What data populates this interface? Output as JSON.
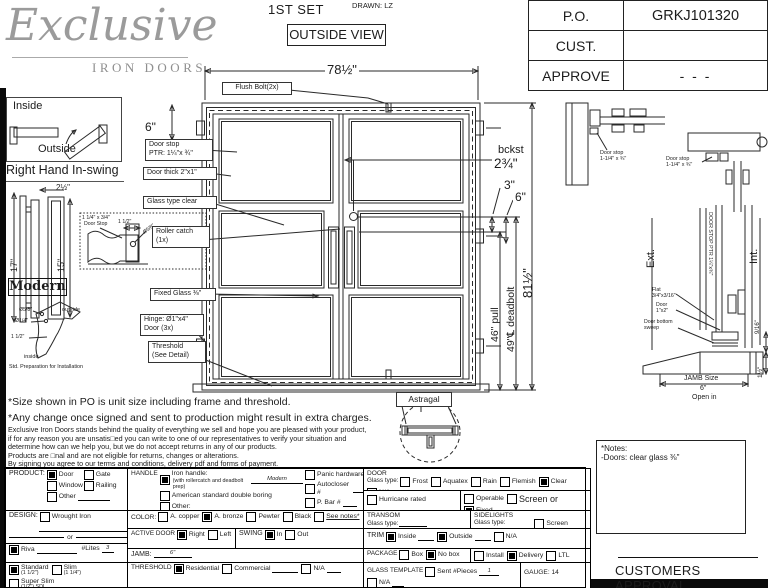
{
  "header": {
    "logo": "Exclusive",
    "logo_sub": "IRON DOORS",
    "set": "1ST SET",
    "drawn": "DRAWN: LZ",
    "view": "OUTSIDE VIEW"
  },
  "po": {
    "rows": [
      {
        "label": "P.O.",
        "value": "GRKJ101320"
      },
      {
        "label": "CUST.",
        "value": ""
      },
      {
        "label": "APPROVE",
        "value": "- - -"
      }
    ]
  },
  "legend": {
    "inside": "Inside",
    "outside": "Outside",
    "caption": "Right Hand In-swing"
  },
  "handle_detail": {
    "width": "2½\"",
    "h1": "17\"",
    "h2": "15\"",
    "style": "Modern"
  },
  "stop_detail": {
    "l1": "1 1/4\" x 3/4\"",
    "l2": "Door Stop",
    "dim": "1 1/2\"",
    "hole": "Ø5/8\""
  },
  "prep_detail": {
    "d1": "Ø5/8\"",
    "d2": "Ø1/4\"",
    "d3": "1 1/2\"",
    "outside": "outside",
    "inside": "inside",
    "caption": "Std. Preparation for Installation"
  },
  "drawing": {
    "width": "78½\"",
    "flush_bolt": "Flush Bolt(2x)",
    "top_rail": "6\"",
    "door_stop": "Door stop\nPTR: 1¼\"x ¾\"",
    "door_thick": "Door thick 2\"x1\"",
    "glass_type": "Glass type clear",
    "roller": "Roller catch\n(1x)",
    "fixed_glass": "Fixed Glass ⅜\"",
    "hinge": "Hinge: Ø1\"x4\"\nDoor (3x)",
    "threshold": "Threshold\n(See Detail)",
    "bckst": "bckst",
    "backset": "2¾\"",
    "d3": "3\"",
    "d6": "6\"",
    "height": "81½\"",
    "deadbolt": "49\"℄ deadbolt",
    "pull": "46\" pull",
    "astragal": "Astragal"
  },
  "jamb": {
    "stop_a": "Door stop\n1-1/4\" x ¾\"",
    "stop_b": "Door stop\n1-1/4\" x ¾\""
  },
  "sill": {
    "ext": "Ext.",
    "int": "Int.",
    "stop_ptr": "DOOR STOP PTR 1¼\"x¾\"",
    "flat": "Flat\n3/4\"x3/16\"",
    "door": "Door\n1\"x2\"",
    "sweep": "Door bottom\nsweep",
    "jamb_size": "JAMB Size",
    "jamb_dim": "6\"",
    "open": "Open in",
    "d916": "9/16\"",
    "d112": "1½\""
  },
  "disclaimer": {
    "l1": "*Size shown in PO is unit size including frame and threshold.",
    "l2": "*Any change once signed and sent to production might result in extra charges.",
    "l3": "Exclusive Iron Doors stands behind the quality of everything we sell and hope you are pleased with your product,",
    "l4": "if for any reason you are unsatis□ed you can write to one of our representatives to verify your situation and",
    "l5": "determine how can we help you, but we do not accept returns in any of our products.",
    "l6": "Products are □nal and are not eligible for returns, changes or alterations.",
    "l7": "By signing you agree to our terms and conditions, delivery pdf and forms of payment.",
    "l8": "*Doors measurements do not include the gaps between jambs"
  },
  "form": {
    "product": {
      "label": "PRODUCT:",
      "options": [
        {
          "label": "Door",
          "checked": true,
          "w": 34
        },
        {
          "label": "Gate",
          "w": 30
        },
        {
          "label": "Window",
          "w": 34
        },
        {
          "label": "Railing",
          "w": 30
        },
        {
          "label": "Other",
          "line": 32
        }
      ]
    },
    "design": {
      "label": "DESIGN:",
      "options": [
        {
          "label": "Wrought Iron"
        }
      ],
      "or": "or"
    },
    "riva": {
      "options": [
        {
          "label": "Riva",
          "checked": true,
          "line": 40
        }
      ],
      "lites_label": "#Lites",
      "lites_value": "3"
    },
    "thickness": {
      "options": [
        {
          "label": "Standard",
          "sub": "(1 1/2\")",
          "checked": true,
          "stack": true
        },
        {
          "label": "Slim",
          "sub": "(1 1/4\")",
          "stack": true
        },
        {
          "label": "Super Slim",
          "sub": "(1/2\") SDL",
          "stack": true
        }
      ]
    },
    "handle": {
      "label": "HANDLE",
      "left": [
        {
          "label": "Iron handle:",
          "checked": true,
          "line": 52,
          "value": "Modern",
          "sub": "(with rollercatch and deadbolt prep)"
        },
        {
          "label": "American standard double boring"
        },
        {
          "label": "Other:",
          "line": 52
        }
      ],
      "right": [
        {
          "label": "Panic hardware"
        },
        {
          "label": "Autocloser #",
          "line": 14
        },
        {
          "label": "P. Bar #",
          "line": 14
        }
      ]
    },
    "color": {
      "label": "COLOR:",
      "options": [
        {
          "label": "A. copper"
        },
        {
          "label": "A. bronze",
          "checked": true
        },
        {
          "label": "Pewter"
        },
        {
          "label": "Black"
        },
        {
          "label": "See notes*",
          "u": true
        }
      ]
    },
    "active_door": {
      "label": "ACTIVE DOOR",
      "options": [
        {
          "label": "Right",
          "checked": true
        },
        {
          "label": "Left"
        }
      ]
    },
    "swing": {
      "label": "SWING",
      "options": [
        {
          "label": "In",
          "checked": true
        },
        {
          "label": "Out"
        }
      ]
    },
    "jamb": {
      "label": "JAMB:",
      "value": "6\""
    },
    "threshold": {
      "label": "THRESHOLD",
      "options": [
        {
          "label": "Residential",
          "checked": true
        },
        {
          "label": "Commercial",
          "line": 26
        },
        {
          "label": "N/A",
          "line": 14
        }
      ]
    },
    "door_glass": {
      "label": "DOOR",
      "sub": "Glass type:",
      "options": [
        {
          "label": "Frost"
        },
        {
          "label": "Aquatex"
        },
        {
          "label": "Rain"
        },
        {
          "label": "Flemish"
        },
        {
          "label": "Clear",
          "checked": true
        },
        {
          "label": "N/A"
        }
      ]
    },
    "hurricane": {
      "options": [
        {
          "label": "Hurricane rated"
        }
      ]
    },
    "operable": {
      "options": [
        {
          "label": "Operable"
        },
        {
          "label": "Screen or",
          "big": true
        },
        {
          "label": "Fixed",
          "checked": true
        }
      ]
    },
    "transom": {
      "label": "TRANSOM",
      "sub": "Glass type:",
      "line": 28
    },
    "sidelights": {
      "label": "SIDELIGHTS",
      "sub": "Glass type:",
      "line": 26,
      "options": [
        {
          "label": "Screen"
        }
      ]
    },
    "trim": {
      "label": "TRIM",
      "options": [
        {
          "label": "Inside",
          "checked": true,
          "line": 16
        },
        {
          "label": "Outside",
          "checked": true,
          "line": 16
        },
        {
          "label": "N/A"
        }
      ]
    },
    "package": {
      "label": "PACKAGE",
      "options_a": [
        {
          "label": "Box"
        },
        {
          "label": "No box",
          "checked": true
        }
      ],
      "options_b": [
        {
          "label": "Install"
        },
        {
          "label": "Delivery",
          "checked": true
        },
        {
          "label": "LTL"
        }
      ]
    },
    "glass_template": {
      "label": "GLASS TEMPLATE",
      "options": [
        {
          "label": "Sent #Pieces",
          "line": 20,
          "value": "1"
        },
        {
          "label": "N/A",
          "line": 12
        }
      ]
    },
    "gauge": "GAUGE: 14"
  },
  "notes": {
    "title": "*Notes:",
    "line1": "-Doors: clear glass ⅜\""
  },
  "approval": "CUSTOMERS APPROVAL"
}
